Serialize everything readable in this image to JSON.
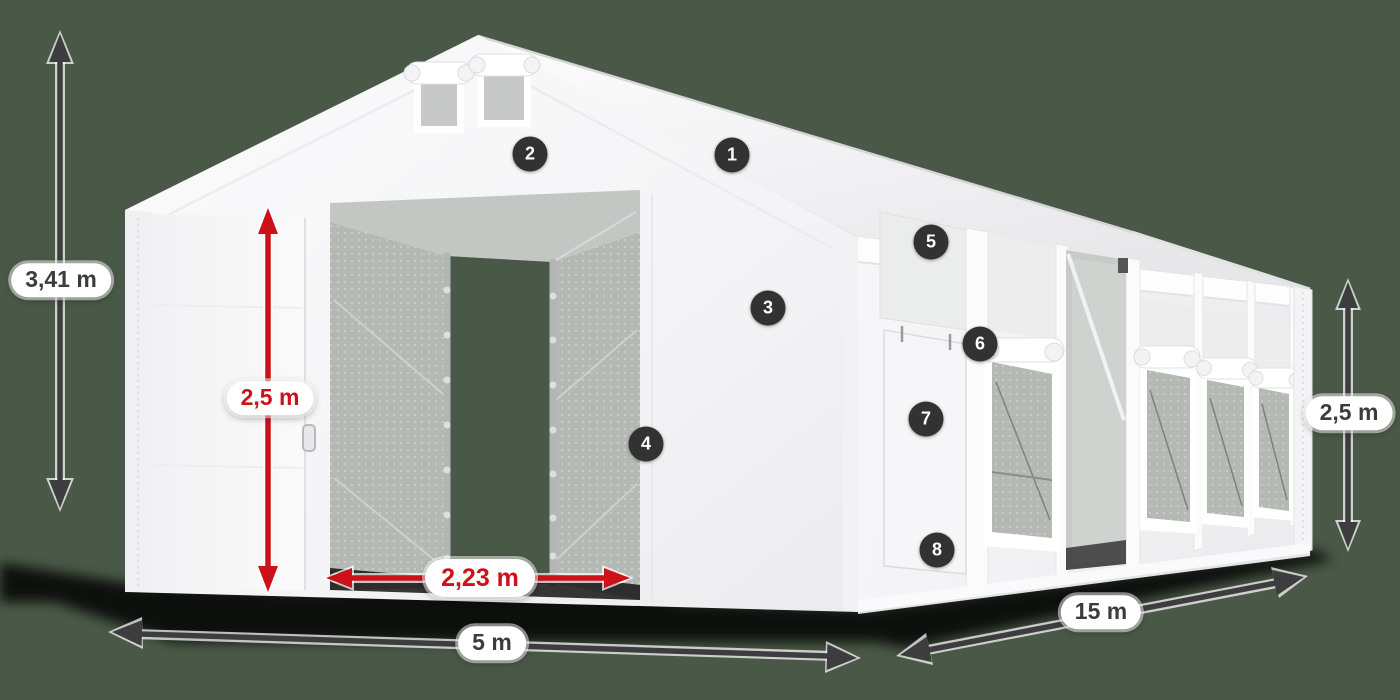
{
  "diagram": {
    "title": "tent-dimension-diagram",
    "labels": {
      "total_height": "3,41 m",
      "door_height": "2,5 m",
      "door_width": "2,23 m",
      "tent_width": "5 m",
      "tent_length": "15 m",
      "side_wall_height": "2,5 m"
    },
    "badges": [
      {
        "number": "1"
      },
      {
        "number": "2"
      },
      {
        "number": "3"
      },
      {
        "number": "4"
      },
      {
        "number": "5"
      },
      {
        "number": "6"
      },
      {
        "number": "7"
      },
      {
        "number": "8"
      }
    ]
  },
  "colors": {
    "background": "#4a5947",
    "accent-red": "#cc1218",
    "arrow-dark": "#3d3d3f",
    "badge-bg": "#323232",
    "label-dark": "#3c3c3e",
    "mesh-gray": "#b4b9b4"
  }
}
